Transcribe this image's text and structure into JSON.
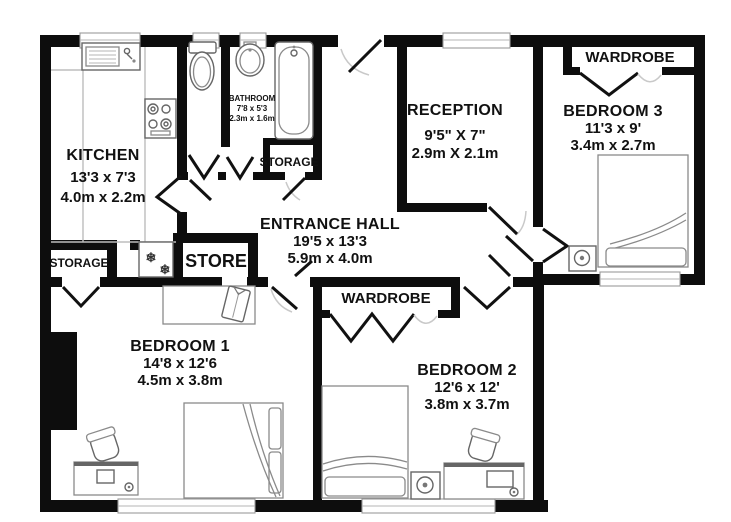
{
  "meta": {
    "type": "floor-plan",
    "background": "#ffffff",
    "wall_color": "#0d0d0d",
    "fixture_color": "#8a8a8a",
    "text_color": "#111111"
  },
  "rooms": {
    "kitchen": {
      "name": "KITCHEN",
      "imperial": "13'3 x 7'3",
      "metric": "4.0m x 2.2m"
    },
    "bathroom": {
      "name": "BATHROOM",
      "imperial": "7'8 x 5'3",
      "metric": "2.3m x 1.6m"
    },
    "storage_bathroom": {
      "name": "STORAGE"
    },
    "reception": {
      "name": "RECEPTION",
      "imperial": "9'5\" X 7\"",
      "metric": "2.9m X 2.1m"
    },
    "bedroom3": {
      "name": "BEDROOM 3",
      "imperial": "11'3 x 9'",
      "metric": "3.4m x 2.7m"
    },
    "wardrobe_bedroom3": {
      "name": "WARDROBE"
    },
    "entrance_hall": {
      "name": "ENTRANCE HALL",
      "imperial": "19'5 x 13'3",
      "metric": "5.9m x 4.0m"
    },
    "storage_hall": {
      "name": "STORAGE"
    },
    "store": {
      "name": "STORE"
    },
    "bedroom1": {
      "name": "BEDROOM 1",
      "imperial": "14'8 x 12'6",
      "metric": "4.5m x 3.8m"
    },
    "wardrobe_bedroom2": {
      "name": "WARDROBE"
    },
    "bedroom2": {
      "name": "BEDROOM 2",
      "imperial": "12'6 x 12'",
      "metric": "3.8m x 3.7m"
    }
  },
  "icons": {
    "snowflake": "❄"
  }
}
